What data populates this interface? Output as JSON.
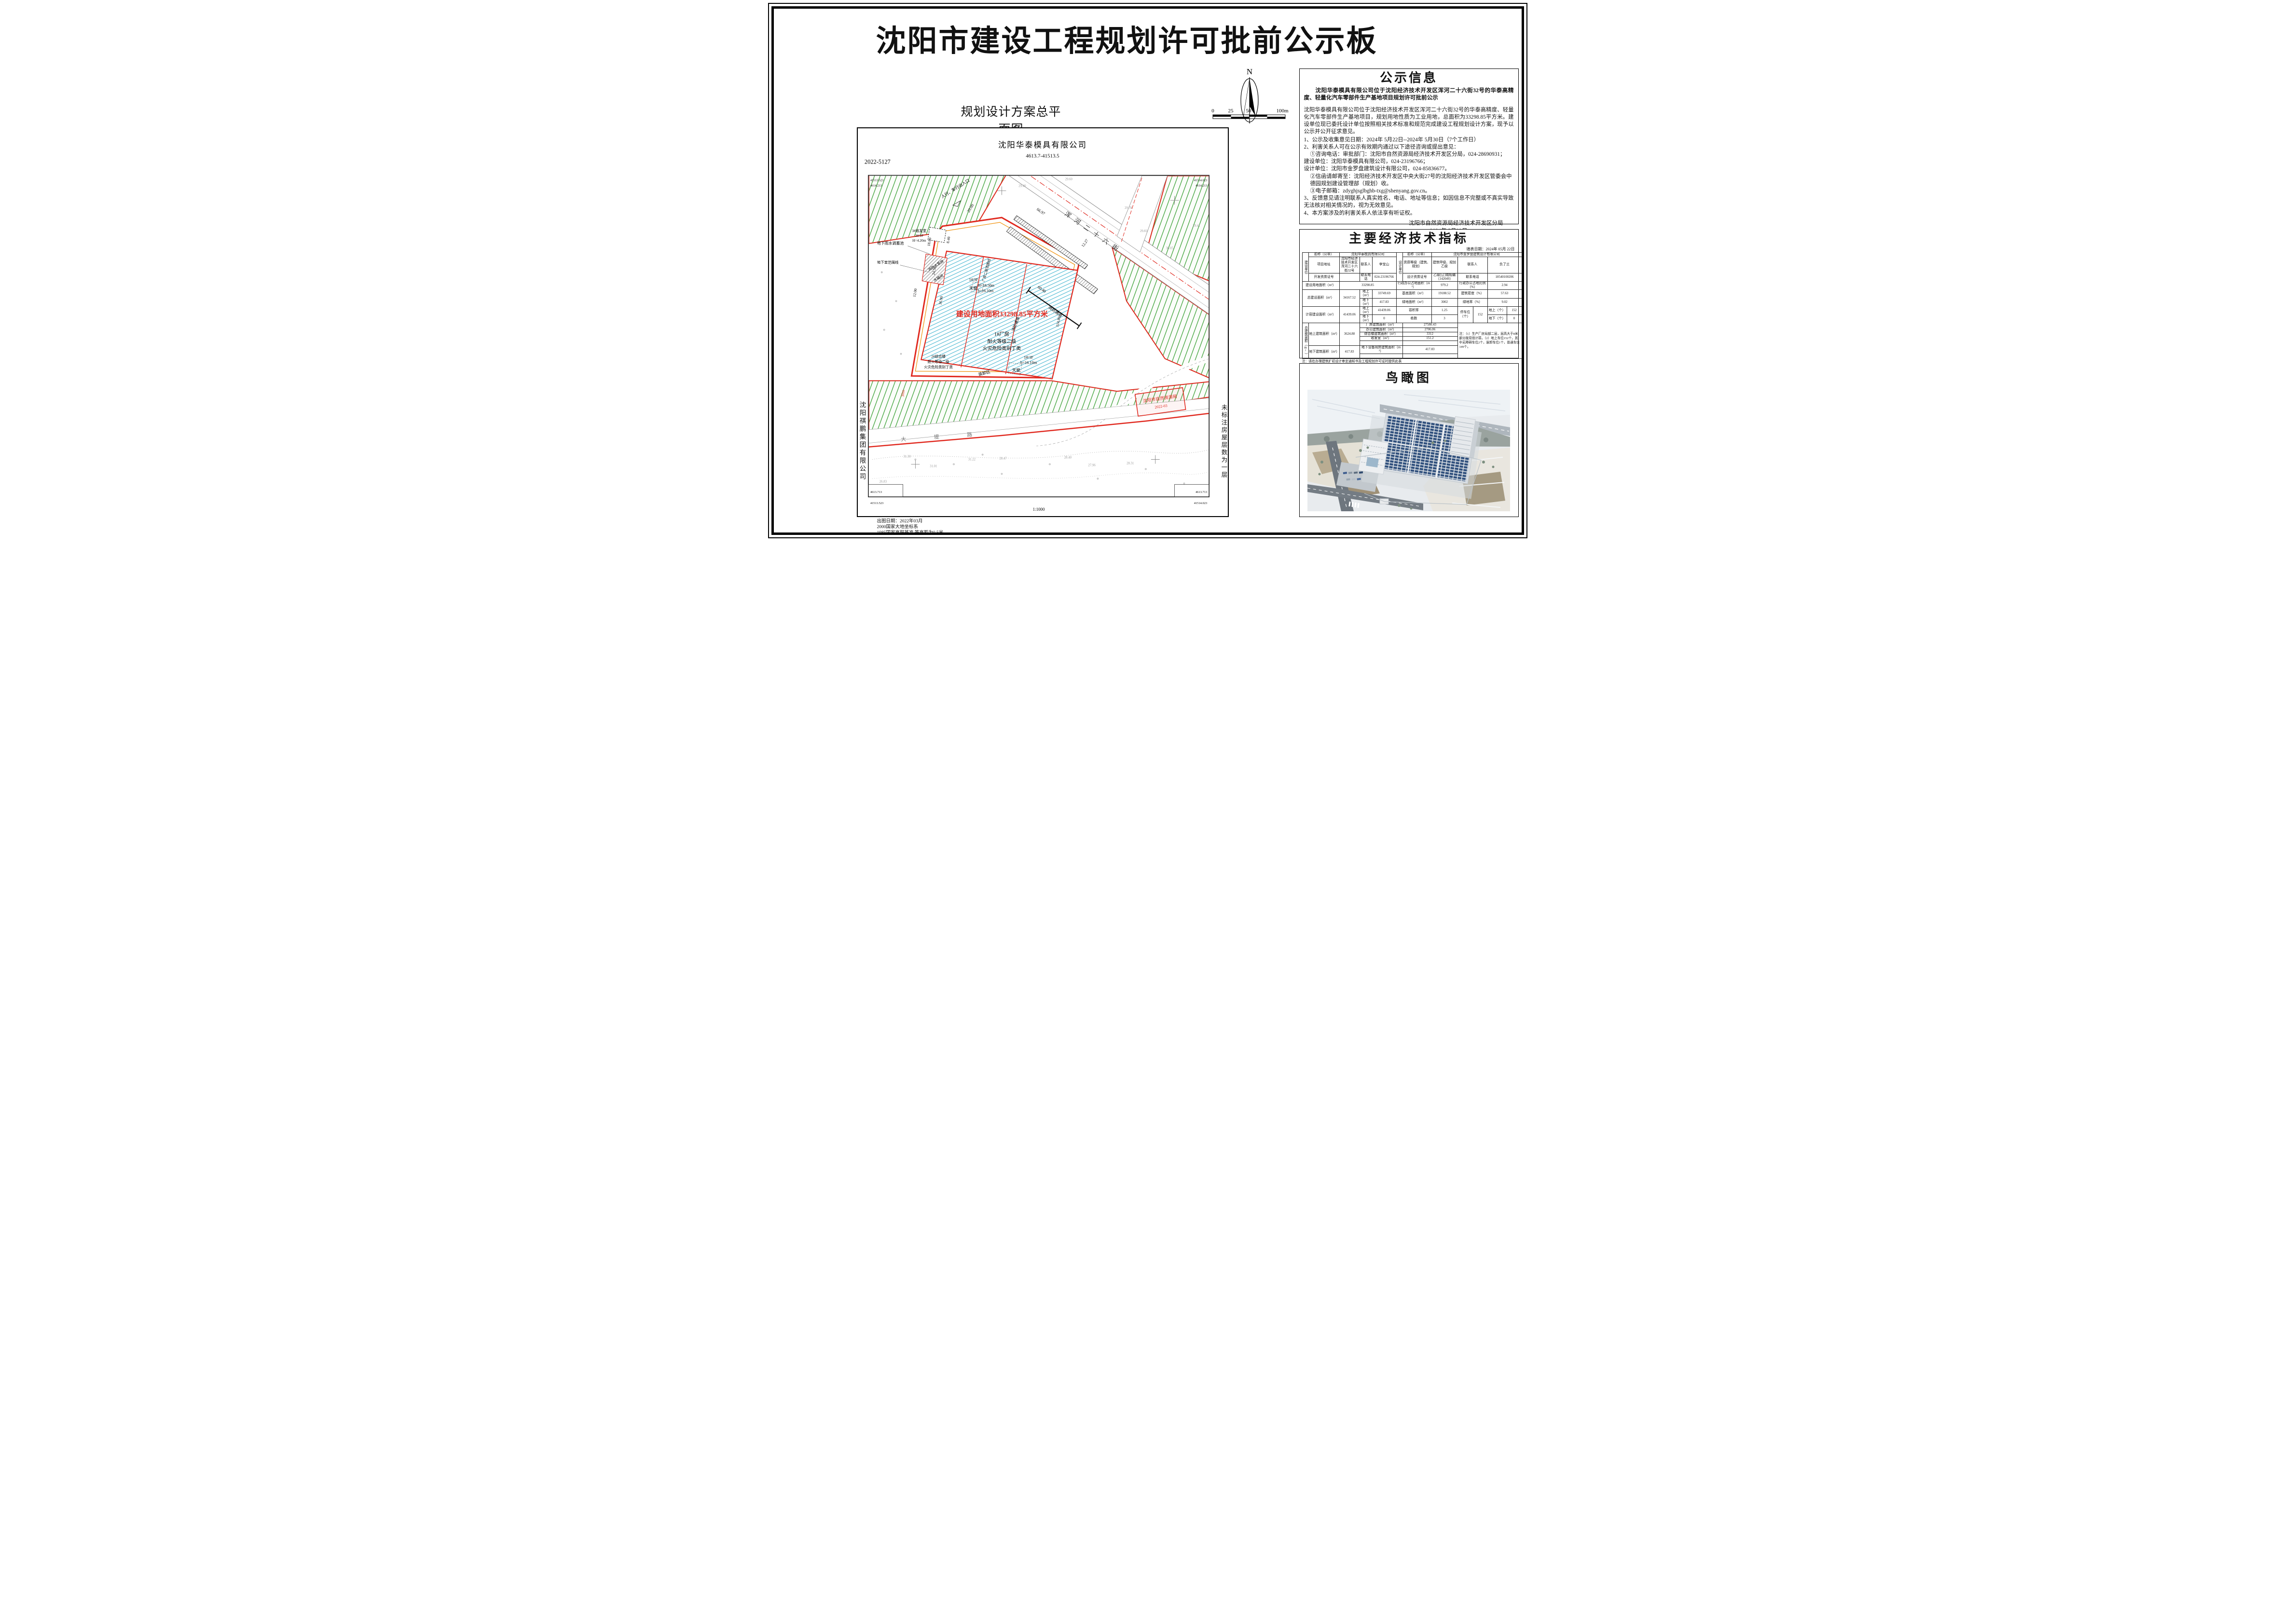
{
  "page_title": "沈阳市建设工程规划许可批前公示板",
  "plan": {
    "title": "规划设计方案总平面图",
    "compass": "N",
    "scalebar": [
      "0",
      "25",
      "50",
      "100m"
    ],
    "company": "沈阳华泰模具有限公司",
    "company_ref": "4613.7-41513.5",
    "drawing_no": "2022-5127",
    "scale_text": "1:1000",
    "left_vertical": "沈阳祺鹏集团有限公司",
    "right_vertical": "未标注房屋层数为一层",
    "notes": [
      "出图日期：2022年03月",
      "2000国家大地坐标系",
      "1985国家高程基准,等高距为0.5米."
    ],
    "corner": {
      "tl_a": "41513.523",
      "tl_b": "4614.213",
      "tr_a": "41514.023",
      "tr_b": "4614.213",
      "bl_a": "4613.713",
      "bl_b": "41513.523",
      "br_a": "4613.713",
      "br_b": "41514.023"
    },
    "stamp": {
      "line1": "沈阳市自然资源局",
      "line2": "2022-03"
    },
    "ann": {
      "area_red": "建设用地面积33298.85平方米",
      "street": "浑河二十六街",
      "road_bottom": "大堤路",
      "entrance": "人行、车行出入口",
      "fire_lane": "消防通道",
      "pump_house": "消防水泵房",
      "tank_room": "水箱间",
      "skylight": "天窗",
      "factory1": "1#厂房",
      "fire_grade": "耐火等级二级",
      "hazard_class": "火灾危险类别丁类",
      "b1_1f": "1#/1F",
      "b1_3f": "1#/3F",
      "H1850": "H=18.50m",
      "h1610": "h=16.10m",
      "b2": "2#综合楼",
      "b3": "3#收发室",
      "b3_1f": "3#/1F",
      "H420": "H=4.20m",
      "loading": "装卸区",
      "rain_tank": "地下雨水调蓄池",
      "basement_line": "地下室范围线",
      "second_floor_line": "厂房二层范围线",
      "d1": "66.97",
      "d2": "20.00",
      "d3": "18.00",
      "d4": "24.50",
      "d5": "36.90",
      "d6": "8.40",
      "d7": "12.00",
      "d8": "60.40",
      "d9": "114.80",
      "d10": "12.27",
      "d11": "30m"
    },
    "spots": [
      "29.40",
      "29.60",
      "29.78",
      "29.83",
      "30.05",
      "29.41",
      "28.47",
      "28.40",
      "27.96",
      "28.31",
      "31.30",
      "31.22",
      "31.01",
      "26.83"
    ]
  },
  "notice": {
    "title": "公示信息",
    "headline": "沈阳华泰模具有限公司位于沈阳经济技术开发区浑河二十六街32号的华泰高精度、轻量化汽车零部件生产基地项目规划许可批前公示",
    "body": "沈阳华泰模具有限公司位于沈阳经济技术开发区浑河二十六街32号的华泰高精度、轻量化汽车零部件生产基地项目，规划用地性质为工业用地，总面积为33298.85平方米。建设单位现已委托设计单位按照相关技术标准和规范完成建设工程规划设计方案，现予以公示并公开征求意见。",
    "items": [
      "1、公示及收集意见日期：2024年 5月22日--2024年 5月30日（7个工作日）",
      "2、利害关系人可在公示有效期内通过以下途径咨询或提出意见：",
      "①咨询电话：审批部门：沈阳市自然资源局经济技术开发区分局，024-28690931；",
      "建设单位：沈阳华泰模具有限公司，024-23196766；",
      "设计单位：沈阳市金罗盘建筑设计有限公司，024-85836677。",
      "②信函请邮寄至：沈阳经济技术开发区中央大街27号的沈阳经济技术开发区管委会中德园规划建设管理部（规划）收。",
      "③电子邮箱：zdyghjsglbghb-txg@shenyang.gov.cn。",
      "3、反馈意见请注明联系人真实姓名、电话、地址等信息；如因信息不完整或不真实导致无法核对相关情况的，视为无效意见。",
      "4、本方案涉及的利害关系人依法享有听证权。"
    ],
    "signature": "沈阳市自然资源局经济技术开发区分局",
    "date": "2024年 5月22日"
  },
  "econ": {
    "title": "主要经济技术指标",
    "date_line": "填表日期：2024年 05月 22日",
    "t": {
      "unit_left": "建设单位",
      "unit_right": "设计单位",
      "name_label": "名称（公章）",
      "name_left": "沈阳华泰模具有限公司",
      "name_right": "沈阳市金罗盘建筑设计有限公司",
      "addr_label": "项目地址",
      "addr": "沈阳市经济技术开发区浑河二十六街32号",
      "contact_label": "联系人",
      "contact_left": "李宝山",
      "contact_right": "负了兰",
      "qual_label": "资质等级（建筑、规划）",
      "qual": "建筑甲级、规划乙级",
      "dev_cert_label": "开发资质证号",
      "dev_cert": "",
      "phone_label": "联系电话",
      "phone_left": "024-23196766",
      "phone_right": "18540100206",
      "design_cert_label": "设计资质证号",
      "design_cert": "乙级[辽]城规编（142049）",
      "land_label": "建设用地面积（m²）",
      "land": "33298.85",
      "admin_area_label": "行政办公占地面积（m²）",
      "admin_area": "979.2",
      "admin_ratio_label": "行政办公占地比例（%）",
      "admin_ratio": "2.94",
      "total_build_label": "总建设面积（m²）",
      "total_build": "34167.52",
      "above_label": "地上（m²）",
      "above1": "33749.69",
      "below_label": "地下（m²）",
      "below1": "417.83",
      "base_label": "基底面积（m²）",
      "base": "19188.52",
      "density_label": "建筑密度（%）",
      "density": "57.63",
      "green_area_label": "绿地面积（m²）",
      "green_area": "3002",
      "green_ratio_label": "绿地率（%）",
      "green_ratio": "9.02",
      "cap_label": "计容建设面积（m²）",
      "cap": "41439.06",
      "cap_above": "41439.06",
      "cap_below": "0",
      "far_label": "容积率",
      "far": "1.25",
      "blocks_label": "栋数",
      "blocks": "3",
      "parking_label": "停车位（个）",
      "parking": "152",
      "parking_above_label": "地上（个）",
      "parking_above": "152",
      "parking_below_label": "地下（个）",
      "parking_below": "0",
      "gfa_label": "总建筑面积（m²）",
      "gfa_above_label": "地上建筑面积（m²）",
      "gfa_above": "3624.88",
      "factory_label": "厂房建筑面积（m²）",
      "factory": "27580.43",
      "office_label": "办公建筑面积（m²）",
      "office": "2706.06",
      "complex_label": "综合楼建筑面积（m²）",
      "complex": "3312",
      "mail_label": "收发室（m²）",
      "mail": "151.2",
      "gfa_below_label": "地下建筑面积（m²）",
      "gfa_below": "417.83",
      "under_equip_label": "地下设备用房建筑面积（m²）",
      "under_equip": "417.83",
      "note": "注：（1）生产厂房局部二层，层高大于8米部分按双倍计容。（2）地上车位152个，其中无障碍车位2个，装卸车位1个，普通车位149个。"
    },
    "footnotes": [
      "注：请在办理建筑扩初设计审定通知书及工程规划许可证时提供此表",
      "计算建筑面积请严格按照《建筑工程建筑面积计算规范》、《辽宁省住宅与公建用地容积率计算管理规定》（辽住建[2011]71号）、《民用建筑设计统一标准》、《民用建筑通用规范》等填写；"
    ]
  },
  "aerial": {
    "title": "鸟瞰图"
  }
}
